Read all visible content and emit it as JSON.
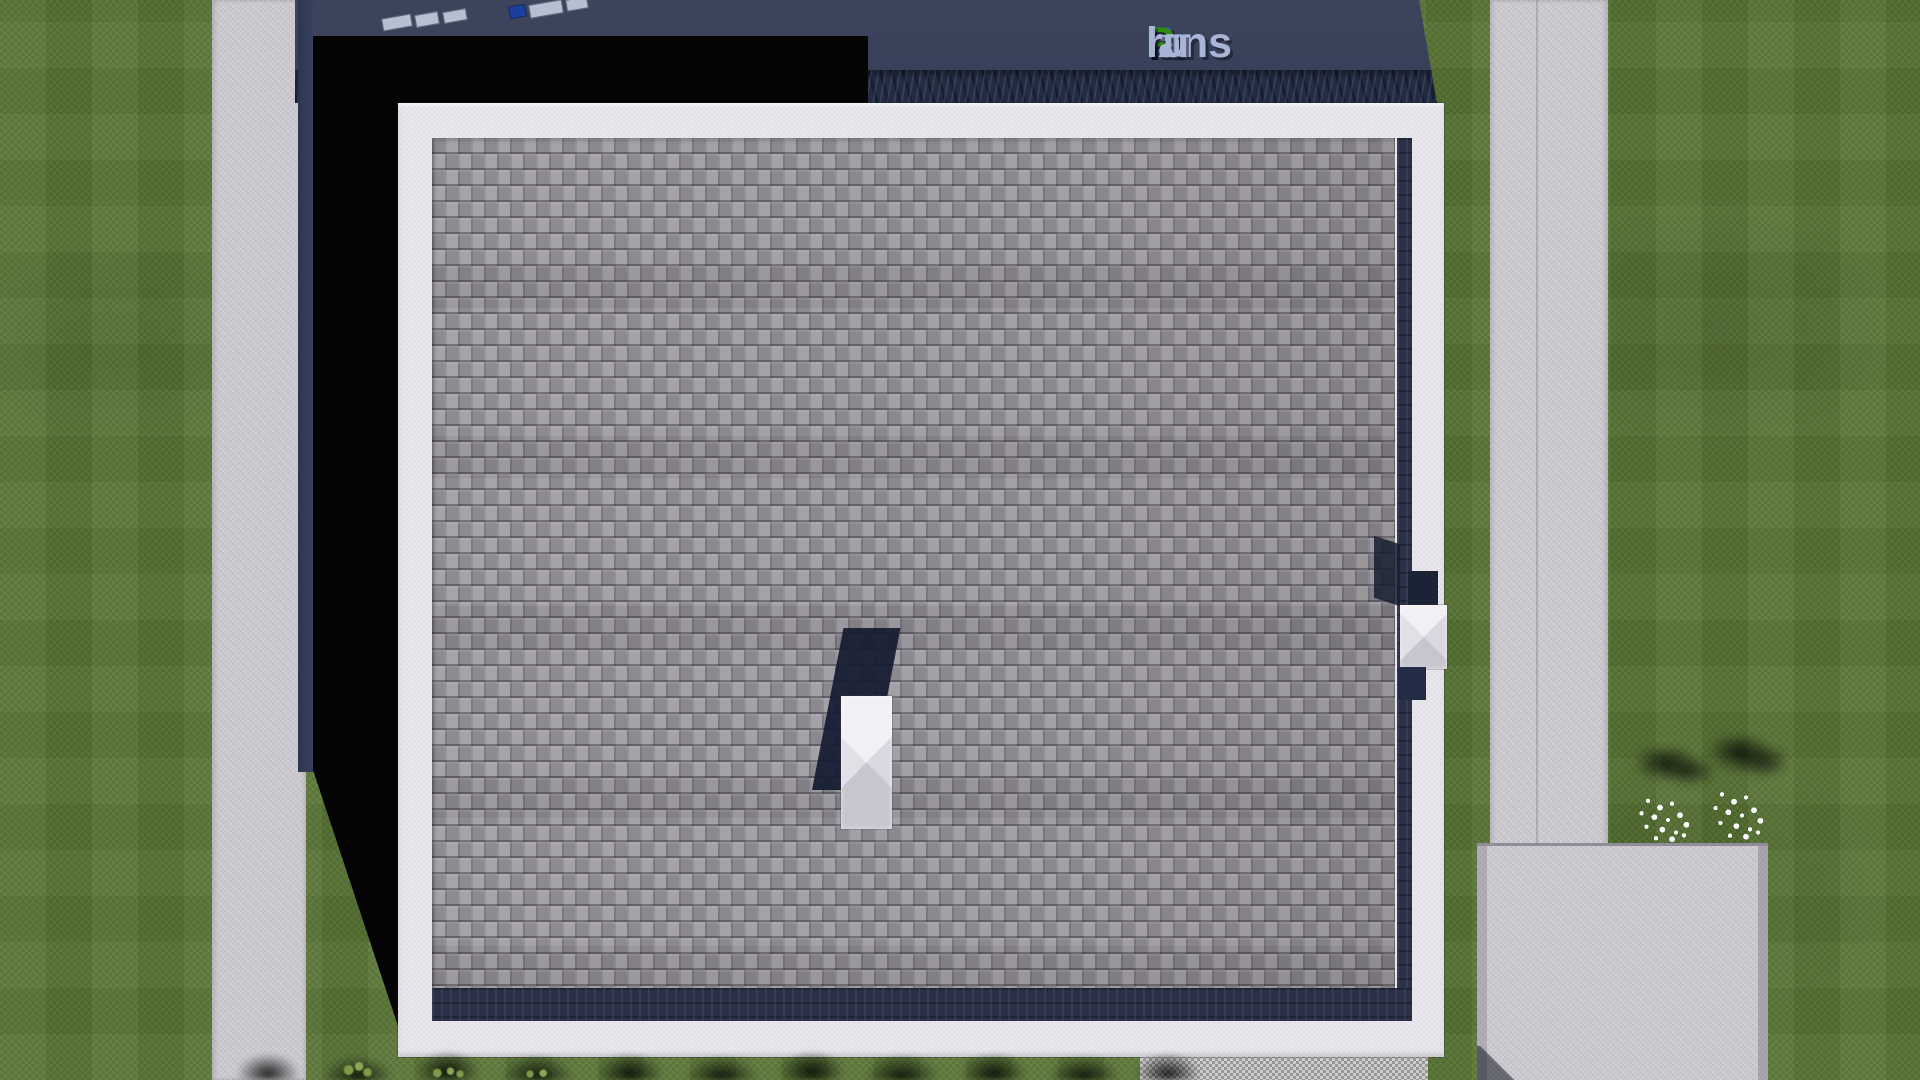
{
  "watermark": {
    "text": "FixPlans.ru",
    "parts": [
      {
        "text": "F",
        "color_key": "logo_blue"
      },
      {
        "text": "ix",
        "color_key": "logo_silver"
      },
      {
        "text": "P",
        "color_key": "logo_green"
      },
      {
        "text": "lans",
        "color_key": "logo_silver"
      },
      {
        "text": ".",
        "color_key": "logo_green"
      },
      {
        "text": "ru",
        "color_key": "logo_silver"
      }
    ]
  },
  "palette": {
    "grass": "#587434",
    "path": "#d0cdd4",
    "navy_band": "#39415a",
    "navy_texture": "#222b42",
    "shadow_black": "#040404",
    "frame_white": "#e9e8ec",
    "shingle_base": "#98949c",
    "shingle_navy": "#2a3147",
    "box_blue": "#1c3f9e",
    "box_light": "#b7c0d3",
    "bush": "#7d9a48",
    "flower": "#ffffff",
    "logo_blue": "#2d54b4",
    "logo_green": "#2e8a12",
    "logo_silver": "#a9b5d6"
  }
}
